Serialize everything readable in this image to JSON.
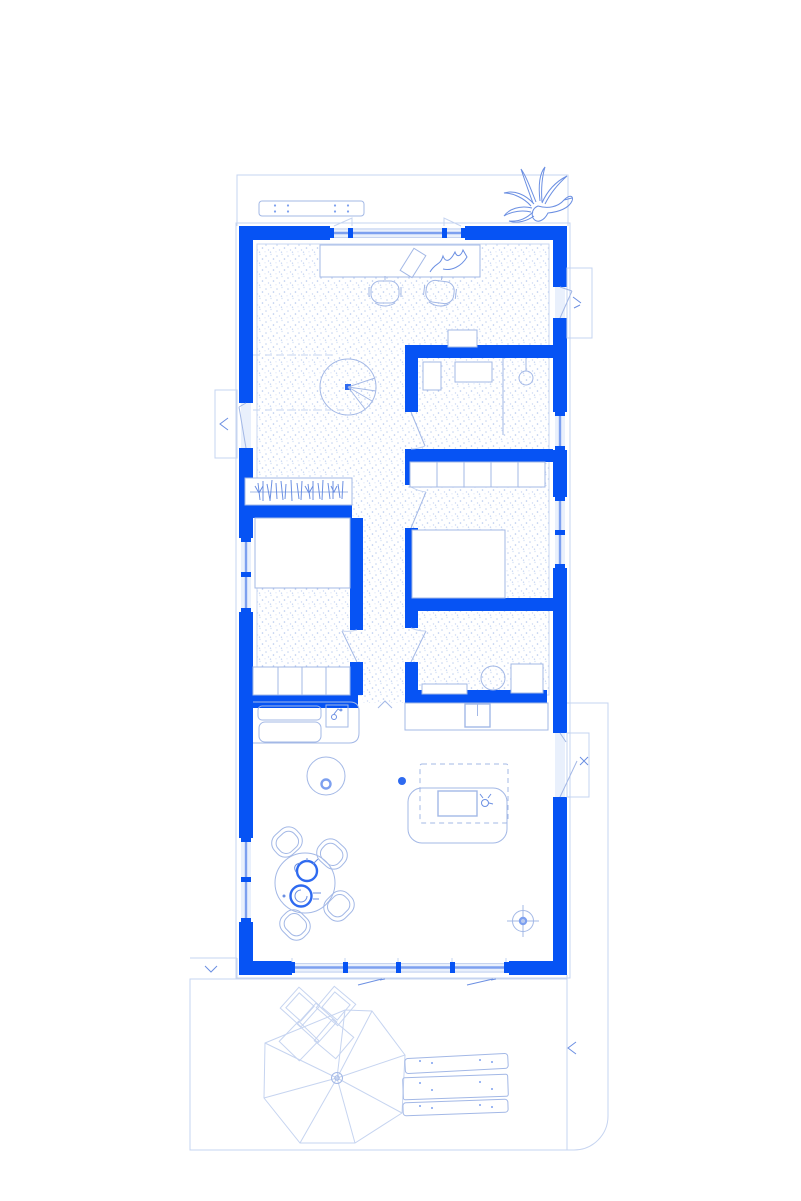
{
  "document": {
    "kind": "architectural-floor-plan",
    "style": "blueprint line drawing, blue on white, no text labels",
    "visible_text": []
  },
  "palette": {
    "wall_blue": "#0653f4",
    "accent_blue": "#2e6af0",
    "glazing_mid_blue": "#7da0ef",
    "glazing_fill": "#e9f0fc",
    "furniture_line": "#a3b8e6",
    "sketch_line": "#6b8fe2",
    "faint_line": "#c6d4f0",
    "stipple_dot": "#c3d3f1",
    "background": "#ffffff"
  },
  "plan": {
    "zones": [
      {
        "name": "terrace-top",
        "items": [
          "bench-with-dowels",
          "bird-sketch"
        ]
      },
      {
        "name": "studio",
        "items": [
          "long-desk",
          "office-chair",
          "office-chair",
          "tilted-book",
          "hand-sketch",
          "spiral-stair",
          "side-table",
          "headroom-dashed-lines"
        ]
      },
      {
        "name": "bathroom",
        "items": [
          "washbasin",
          "counter",
          "round-fixture-with-stem",
          "partition-line",
          "door-swing"
        ]
      },
      {
        "name": "bedroom-right",
        "items": [
          "closet-row-5-sections",
          "double-bed",
          "door-swing"
        ]
      },
      {
        "name": "utility-room",
        "items": [
          "low-bench",
          "laundry-basket-circle",
          "washing-machine-square",
          "door-swing"
        ]
      },
      {
        "name": "bedroom-left",
        "items": [
          "open-wardrobe-hanging-clothes",
          "double-bed",
          "dresser-row-4-sections",
          "door-swing"
        ]
      },
      {
        "name": "living-kitchen",
        "items": [
          "kitchen-counter-left",
          "double-sink",
          "faucet-box",
          "kitchen-counter-top",
          "cooktop-square",
          "step-caret",
          "round-side-table",
          "ceiling-point-dot",
          "skylight-dashed-rect",
          "daybed-sofa",
          "coffee-table",
          "cup-glyph",
          "round-dining-table",
          "dining-chair",
          "dining-chair",
          "dining-chair",
          "dining-chair",
          "teapot",
          "plate-with-spiral",
          "floor-drain-crosshair"
        ]
      },
      {
        "name": "garden-deck",
        "items": [
          "parasol-polygon-8-ribs",
          "cushion-squares-cluster",
          "picnic-table",
          "picnic-bench",
          "picnic-bench",
          "boundary-rounded-corner",
          "downspout-arrow",
          "edge-arrow-left",
          "edge-arrow-right",
          "tick-mark"
        ]
      }
    ],
    "openings": {
      "top-window": {
        "wall": "north",
        "panels": 2
      },
      "left-door": {
        "wall": "west",
        "with_porch_box": true
      },
      "left-window-1": {
        "wall": "west"
      },
      "left-window-2": {
        "wall": "west"
      },
      "right-door-top": {
        "wall": "east",
        "with_porch_box": true
      },
      "right-window-1": {
        "wall": "east"
      },
      "right-window-2": {
        "wall": "east"
      },
      "right-door-bottom": {
        "wall": "east",
        "with_porch_box": true
      },
      "south-sliding-glass": {
        "wall": "south",
        "panels": 4
      }
    },
    "counts": {
      "dining_chairs": 4,
      "closet_sections_right_bedroom": 5,
      "dresser_sections_left_bedroom": 4,
      "sliding_door_mullions": 5,
      "parasol_ribs": 8,
      "office_chairs": 2
    }
  }
}
